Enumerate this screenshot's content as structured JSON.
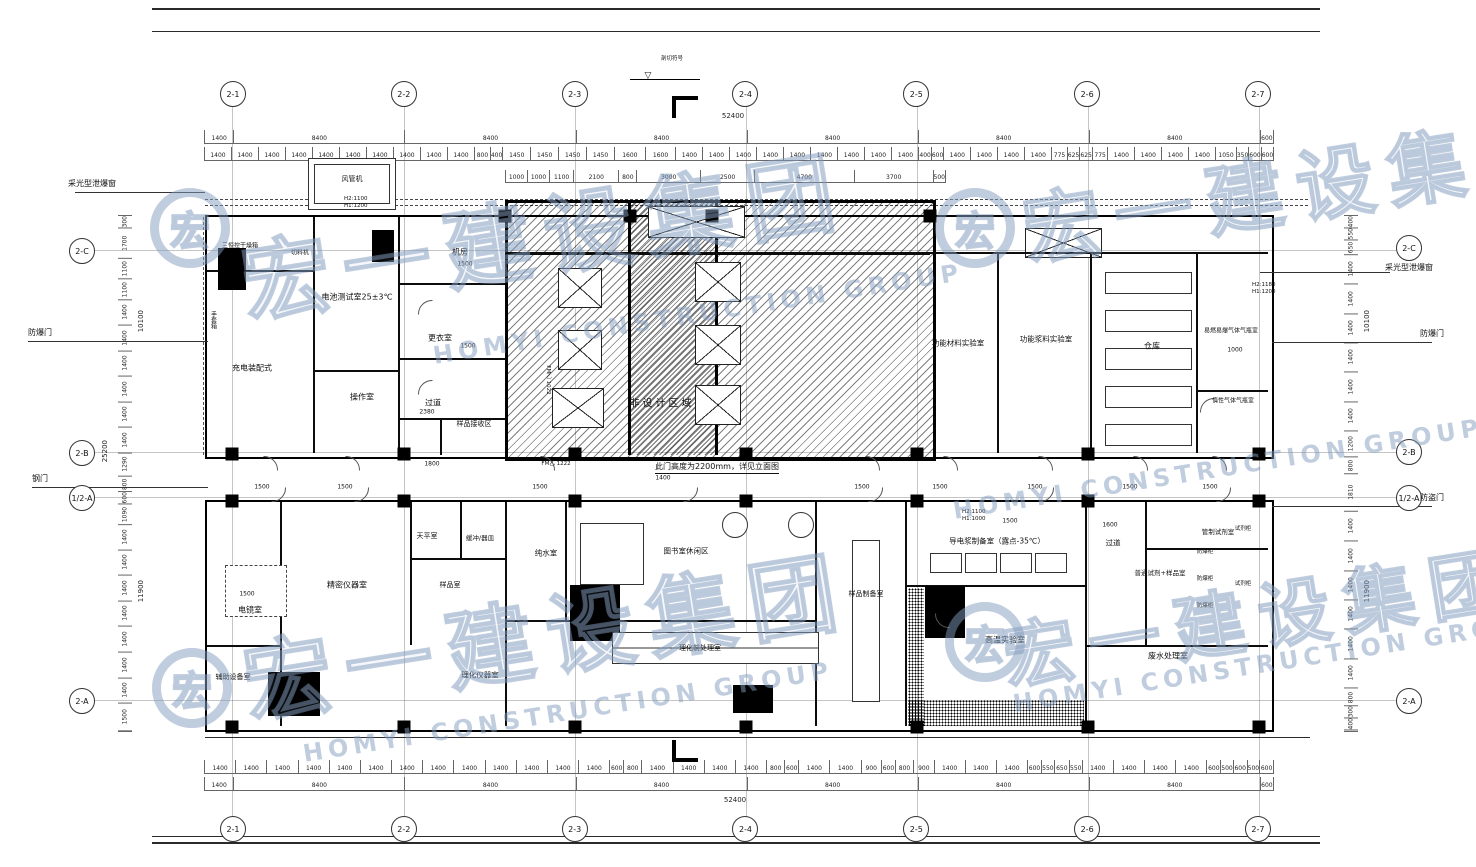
{
  "watermark": {
    "cn": "宏一建设集团",
    "en": "HOMYI CONSTRUCTION GROUP",
    "color": "#829BBE"
  },
  "axes": {
    "cols": [
      "2-1",
      "2-2",
      "2-3",
      "2-4",
      "2-5",
      "2-6",
      "2-7"
    ],
    "row_c": "2-C",
    "row_b": "2-B",
    "row_half": "1/2-A",
    "row_a": "2-A"
  },
  "dims": {
    "total": "52400",
    "left_total": "25200",
    "sec_top": "10100",
    "sec_bottom": "11900",
    "top_spans": [
      "1400",
      "8400",
      "8400",
      "8400",
      "8400",
      "8400",
      "8400",
      "600"
    ],
    "bottom_spans": [
      "1400",
      "8400",
      "8400",
      "8400",
      "8400",
      "8400",
      "8400",
      "600"
    ],
    "top_fine": [
      "1400",
      "1400",
      "1400",
      "1400",
      "1400",
      "1400",
      "1400",
      "1400",
      "1400",
      "1400",
      "800",
      "400",
      "1450",
      "1450",
      "1450",
      "1450",
      "1600",
      "1600",
      "1400",
      "1400",
      "1400",
      "1400",
      "1400",
      "1400",
      "1400",
      "1400",
      "1400",
      "400",
      "600",
      "1400",
      "1400",
      "1400",
      "1400",
      "775",
      "625",
      "625",
      "775",
      "1400",
      "1400",
      "1400",
      "1400",
      "1050",
      "350",
      "600",
      "600"
    ],
    "bottom_fine": [
      "1400",
      "1400",
      "1400",
      "1400",
      "1400",
      "1400",
      "1400",
      "1400",
      "1400",
      "1400",
      "1400",
      "1400",
      "1400",
      "600",
      "800",
      "1400",
      "1400",
      "1400",
      "1400",
      "800",
      "600",
      "1400",
      "1400",
      "900",
      "600",
      "800",
      "900",
      "1400",
      "1400",
      "1400",
      "600",
      "550",
      "650",
      "550",
      "1400",
      "1400",
      "1400",
      "1400",
      "600",
      "500",
      "600",
      "500",
      "600"
    ],
    "top_sub": [
      "1000",
      "1000",
      "1100",
      "2100",
      "800",
      "3000",
      "2500",
      "4700",
      "3700",
      "500"
    ],
    "left_fine": [
      "300",
      "1700",
      "1100",
      "1100",
      "1400",
      "1400",
      "1400",
      "1400",
      "1400",
      "1400",
      "1290",
      "800",
      "600",
      "1090",
      "1400",
      "1400",
      "1400",
      "1400",
      "1400",
      "1400",
      "1400",
      "1500"
    ],
    "right_fine": [
      "400",
      "550",
      "650",
      "1400",
      "1400",
      "1400",
      "1400",
      "1400",
      "1400",
      "1200",
      "800",
      "1810",
      "1400",
      "1400",
      "1400",
      "1400",
      "1400",
      "1400",
      "800",
      "300",
      "400"
    ],
    "inline": {
      "d1500": "1500",
      "d2380": "2380",
      "d1800": "1800",
      "d1400": "1400",
      "d1600": "1600",
      "d1000": "1000"
    }
  },
  "rooms": {
    "battery_test": "电池测试室25±3℃",
    "assembly": "充电装配式",
    "operation": "操作室",
    "machine_room": "机房",
    "changing": "更衣室",
    "corridor_top": "过道",
    "sample_receive": "样品接收区",
    "non_design": "非设计区域",
    "func_material": "功能材料实验室",
    "func_slurry": "功能浆料实验室",
    "warehouse": "仓库",
    "flammable_gas": "易燃易爆气体气瓶室",
    "inert_gas": "惰性气体气瓶室",
    "sem_room": "电镜室",
    "aux_equip": "辅助设备室",
    "precision": "精密仪器室",
    "balance": "天平室",
    "buffer": "缓冲/器皿",
    "sample_room": "样品室",
    "pure_water": "纯水室",
    "library": "图书室休闲区",
    "pretreat": "理化前处理室",
    "physchem": "理化仪器室",
    "sample_prep": "样品制备室",
    "slurry_prep": "导电浆制备室（露点-35℃）",
    "corridor_bottom": "过道",
    "high_temp": "高温实验室",
    "reagent_sample": "普通试剂+样品室",
    "controlled_reagent": "管制试剂室",
    "wastewater": "废水处理室"
  },
  "equipment": {
    "dry_oven": "三恒控干燥箱",
    "cutter": "切料机",
    "glove_box": "手套箱",
    "explosion_cabinet": "防爆柜",
    "reagent_cabinet": "试剂柜",
    "fan_unit": "风管机"
  },
  "annotations": {
    "skylight": "采光型泄爆窗",
    "blast_door": "防爆门",
    "steel_door": "钢门",
    "security_door": "防盗门",
    "door_note": "此门高度为2200mm，详见立面图",
    "fm1022": "FM乙 1022",
    "fm1222": "FM乙 1222",
    "h_top_1": "H2:1100",
    "h_top_2": "H1:1200",
    "h_right_1": "H2:1180",
    "h_right_2": "H1:1200",
    "h_prep_1": "H2:1100",
    "h_prep_2": "H1:1000",
    "section_note": "剖切符号"
  }
}
